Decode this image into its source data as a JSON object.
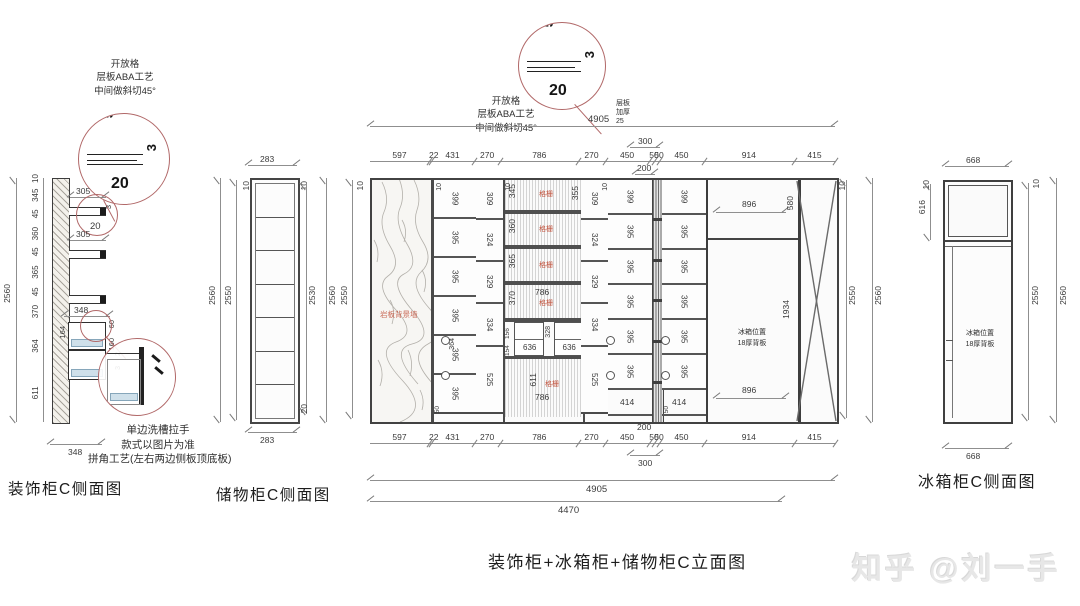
{
  "watermark": "知乎 @刘一手",
  "decor_view": {
    "title": "装饰柜C侧面图",
    "note_top": [
      "开放格",
      "层板ABA工艺",
      "中间做斜切45°"
    ],
    "detail": {
      "top": "5",
      "side": "3",
      "bottom": "20"
    },
    "overall_height": "2560",
    "height_chain": [
      "10",
      "345",
      "45",
      "360",
      "45",
      "365",
      "45",
      "370",
      "364",
      "611"
    ],
    "shelf_depth_1": "305",
    "shelf_depth_2": "305",
    "mini_detail": {
      "bottom": "20",
      "side": "3"
    },
    "top_width": "348",
    "bottom_width": "348",
    "box_left": "164",
    "box_right_top": "60",
    "box_right_mid": "160",
    "box_tiny_1": "2",
    "box_tiny_2": "3",
    "note_bottom": [
      "单边洗槽拉手",
      "款式以图片为准",
      "拼角工艺(左右两边侧板顶底板)"
    ]
  },
  "storage_view": {
    "title": "储物柜C侧面图",
    "top_width": "283",
    "bottom_width": "283",
    "left_overall": "2560",
    "left_inner": "2550",
    "left_top": "10",
    "right_top": "10",
    "right_inner": "2530",
    "right_bottom": "20",
    "right_overall": "2560"
  },
  "elevation": {
    "title": "装饰柜+冰箱柜+储物柜C立面图",
    "note": [
      "开放格",
      "层板ABA工艺",
      "中间做斜切45°"
    ],
    "detail": {
      "top": "5",
      "side": "3",
      "bottom": "20"
    },
    "top_overall": "4905",
    "thickening_note": [
      "层板",
      "加厚",
      "25"
    ],
    "top_300": "300",
    "top_200": "200",
    "top_chain": [
      "597",
      "22",
      "431",
      "270",
      "786",
      "270",
      "450",
      "50",
      "50",
      "450",
      "914",
      "415"
    ],
    "bottom_chain": [
      "597",
      "22",
      "431",
      "270",
      "786",
      "270",
      "450",
      "50",
      "50",
      "450",
      "914",
      "415"
    ],
    "bottom_200": "200",
    "bottom_300": "300",
    "bottom_overall": "4905",
    "bottom_inner": "4470",
    "left_top": "10",
    "left_inner": "2550",
    "right_top": "10",
    "right_inner": "2550",
    "right_outer": "2560",
    "stone_label": "岩板背景墙",
    "plate10": "10",
    "base50": "50",
    "col1_rows": [
      "399",
      "395",
      "395",
      "395",
      "395",
      "395"
    ],
    "col1_gap": "364",
    "col2_rows": [
      "309",
      "324",
      "329",
      "334",
      "525"
    ],
    "col3_rows": [
      "309",
      "324",
      "329",
      "334",
      "525"
    ],
    "col4_rows": [
      "399",
      "395",
      "395",
      "395",
      "395",
      "395"
    ],
    "col4_bottom": "414",
    "col5_rows": [
      "399",
      "395",
      "395",
      "395",
      "395",
      "395"
    ],
    "col5_bottom": "414",
    "mid": {
      "grille_label": "格栅",
      "grille_rows": [
        "345",
        "360",
        "365",
        "370"
      ],
      "top_right": "355",
      "row4_width": "786",
      "drawer_h1": "156",
      "drawer_h2": "154",
      "drawer_w1": "636",
      "drawer_mid": "328",
      "drawer_w2": "636",
      "bottom_height": "611",
      "bottom_width": "786"
    },
    "fridge": {
      "top_width": "896",
      "top_height": "580",
      "height": "1934",
      "bottom_width": "896",
      "note": [
        "冰箱位置",
        "18厚背板"
      ]
    }
  },
  "fridge_view": {
    "title": "冰箱柜C侧面图",
    "top_width": "668",
    "bottom_width": "668",
    "left_top": "10",
    "left_upper": "616",
    "right_top": "10",
    "right_inner": "2550",
    "right_outer": "2560",
    "note": [
      "冰箱位置",
      "18厚背板"
    ]
  }
}
